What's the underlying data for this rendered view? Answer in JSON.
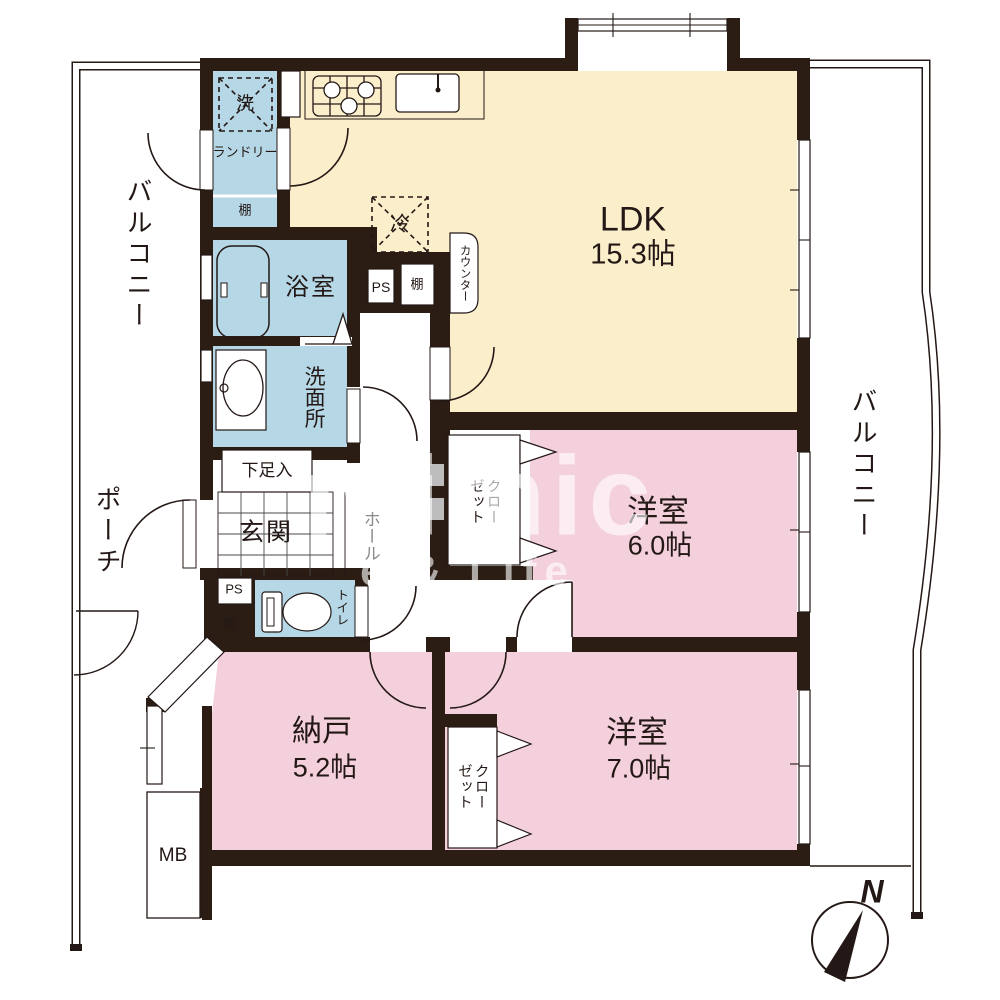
{
  "plan": {
    "rooms": {
      "ldk": {
        "name": "LDK",
        "area": "15.3帖"
      },
      "western6": {
        "name": "洋室",
        "area": "6.0帖"
      },
      "western7": {
        "name": "洋室",
        "area": "7.0帖"
      },
      "storage": {
        "name": "納戸",
        "area": "5.2帖"
      },
      "bath": {
        "name": "浴室"
      },
      "washroom": {
        "name": "洗面所"
      },
      "genkan": {
        "name": "玄関"
      },
      "hall": {
        "name": "ホール"
      },
      "toilet": {
        "name": "トイレ"
      },
      "laundry": {
        "name": "ランドリー"
      }
    },
    "outside": {
      "balcony_left": "バルコニー",
      "balcony_right": "バルコニー",
      "porch": "ポーチ"
    },
    "fixtures": {
      "washer": "洗",
      "fridge": "冷",
      "shelf_laundry": "棚",
      "shelf_kitchen": "棚",
      "shelf_toilet": "棚",
      "ps_kitchen": "PS",
      "ps_toilet": "PS",
      "counter": "カウンター",
      "shoe_box": "下足入",
      "meter_box": "MB",
      "closet_col_right": "クロー",
      "closet_col_left": "ゼット",
      "north": "N"
    },
    "watermark": {
      "big": "mimic",
      "small": "e & Life"
    },
    "colors": {
      "wall": "#2b1d14",
      "ldk_floor": "#faeecb",
      "wet_floor": "#b5d7e6",
      "room_floor": "#f3d0dc"
    }
  }
}
